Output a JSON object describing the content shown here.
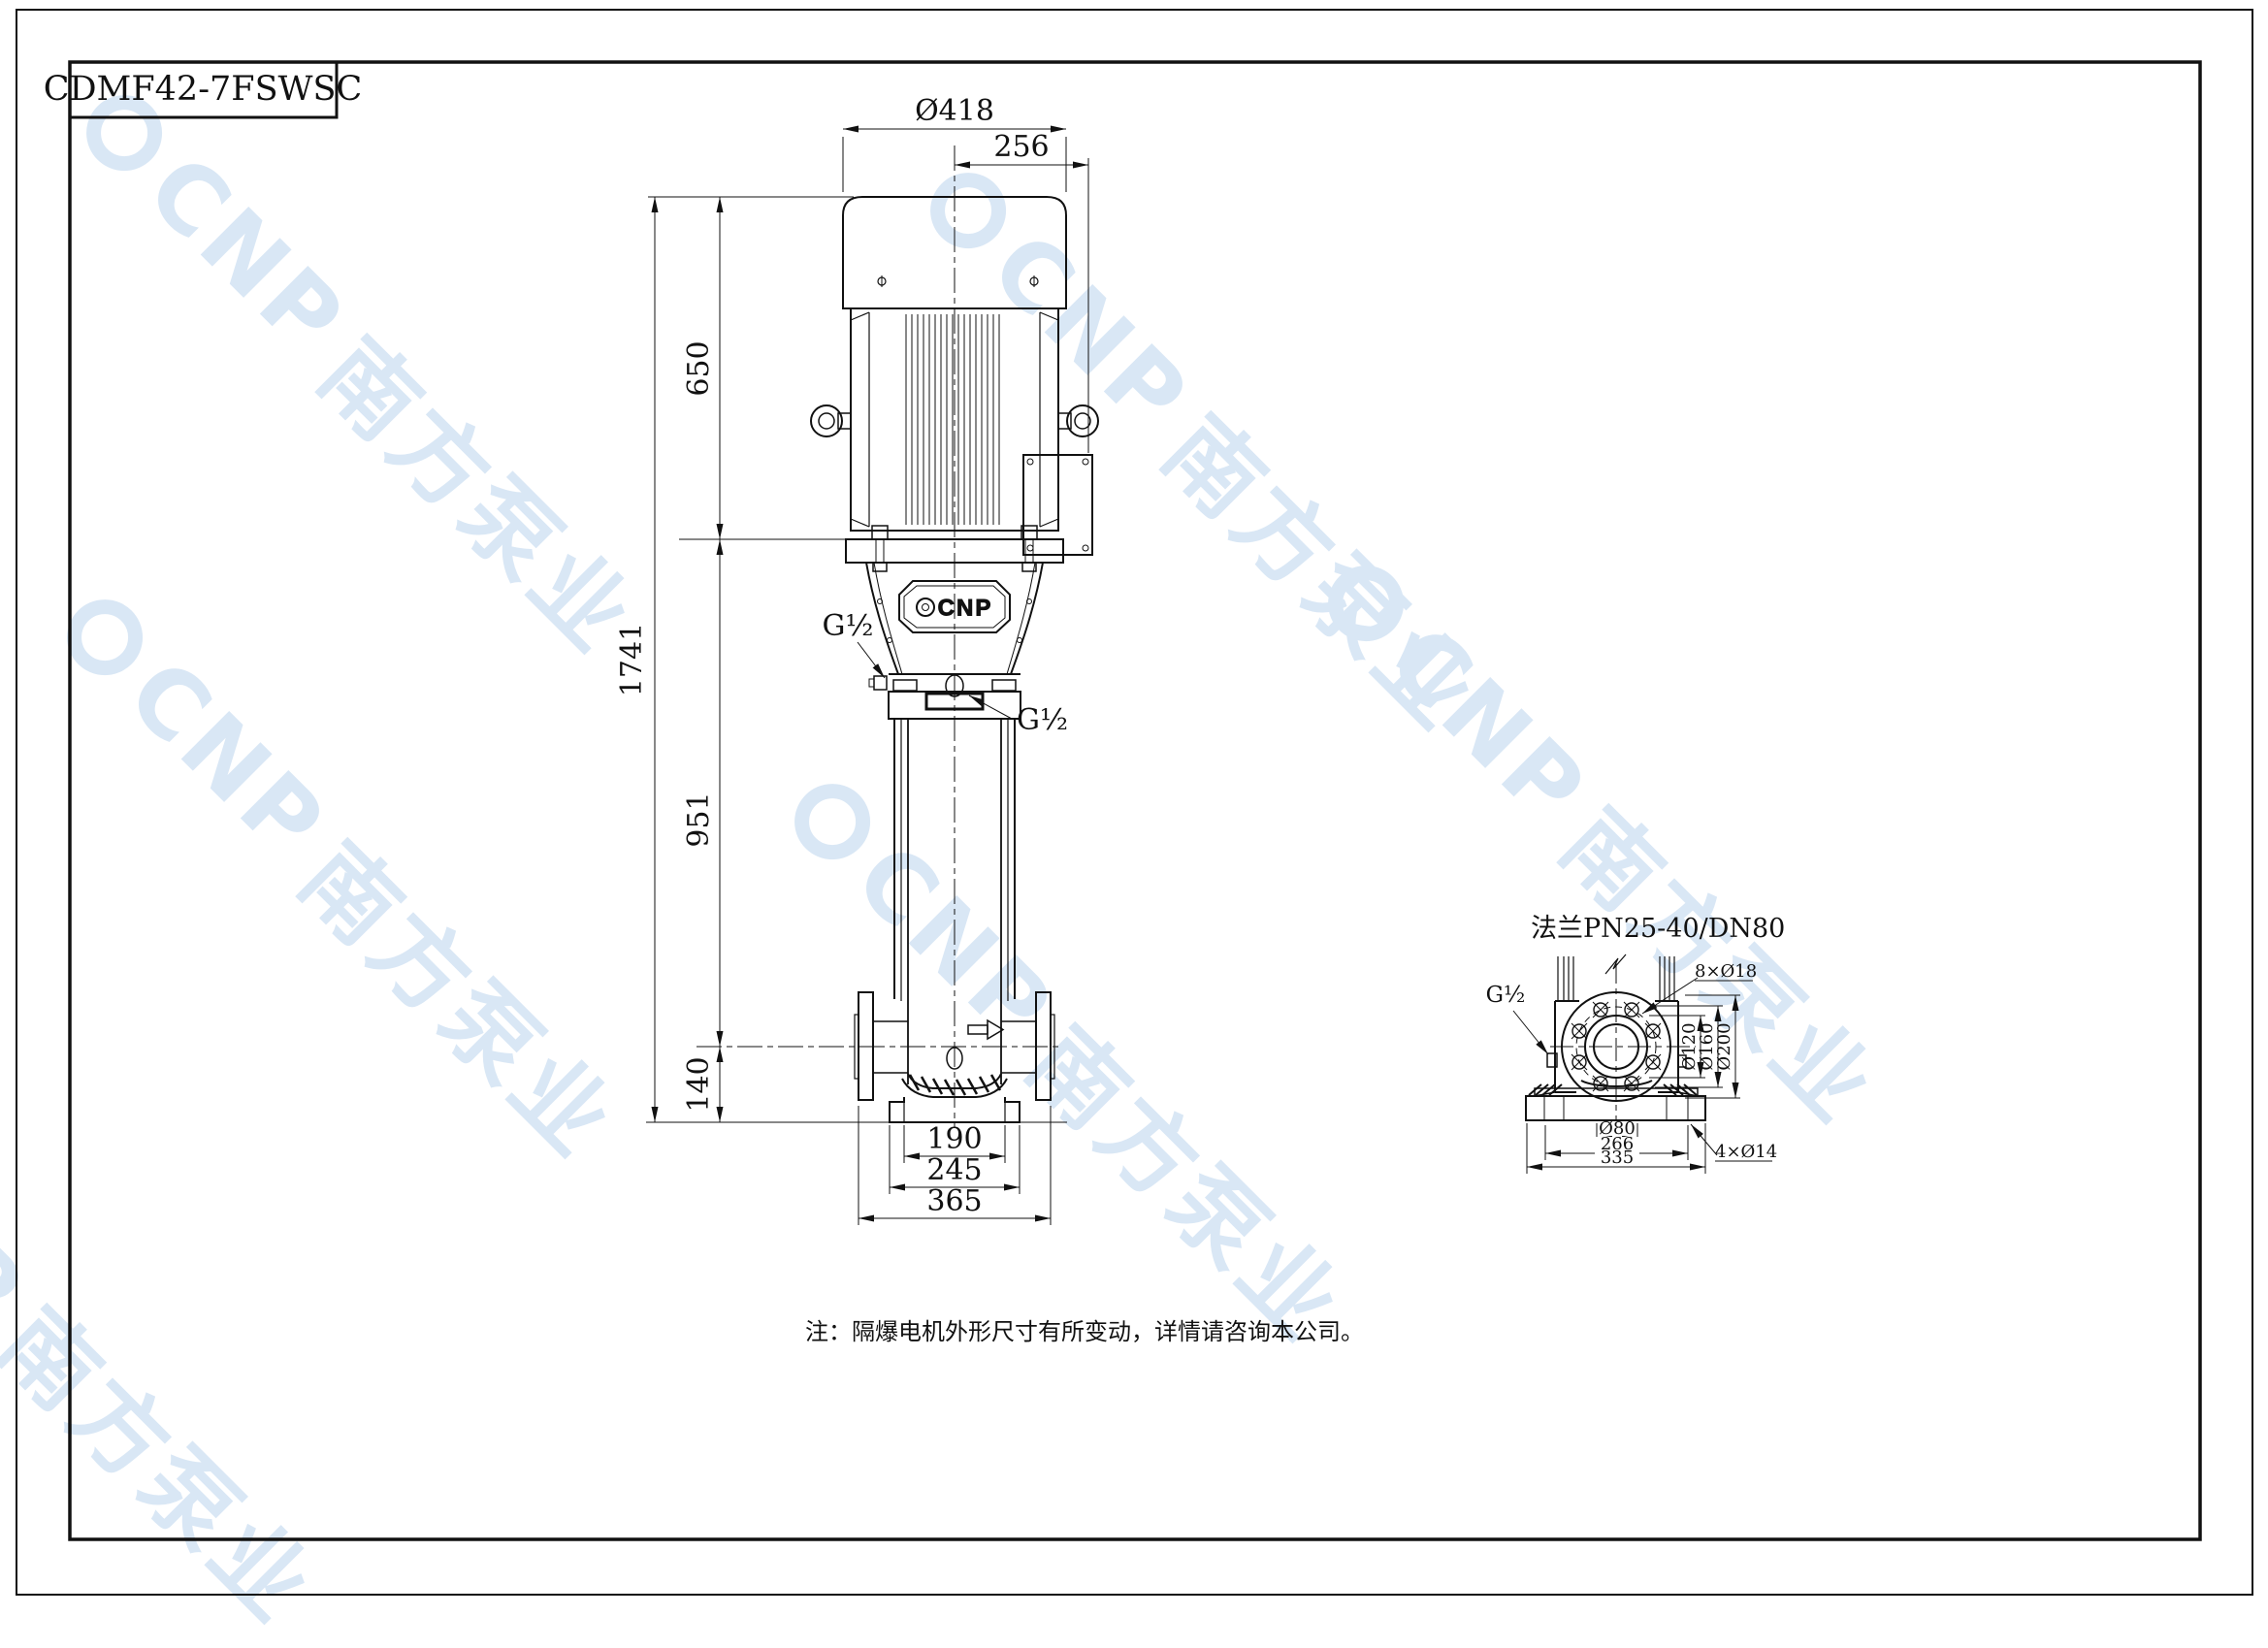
{
  "title_block": {
    "model": "CDMF42-7FSWSC"
  },
  "main_view": {
    "dim_top_diameter": "Ø418",
    "dim_top_offset": "256",
    "dim_motor_height": "650",
    "dim_total_height": "1741",
    "dim_pump_height": "951",
    "dim_base_height": "140",
    "dim_foot_width": "190",
    "dim_base_width": "245",
    "dim_flange_width": "365",
    "port_left": "G½",
    "port_right": "G½",
    "logo_text": "CNP"
  },
  "flange_view": {
    "title": "法兰PN25-40/DN80",
    "dim_bolt_holes": "8×Ø18",
    "dim_d120": "Ø120",
    "dim_d160": "Ø160",
    "dim_d200": "Ø200",
    "dim_d80": "Ø80",
    "dim_w266": "266",
    "dim_w335": "335",
    "dim_feet_holes": "4×Ø14",
    "port": "G½"
  },
  "note": "注：隔爆电机外形尺寸有所变动，详情请咨询本公司。",
  "watermark": {
    "brand": "CNP",
    "company": "南方泵业"
  }
}
